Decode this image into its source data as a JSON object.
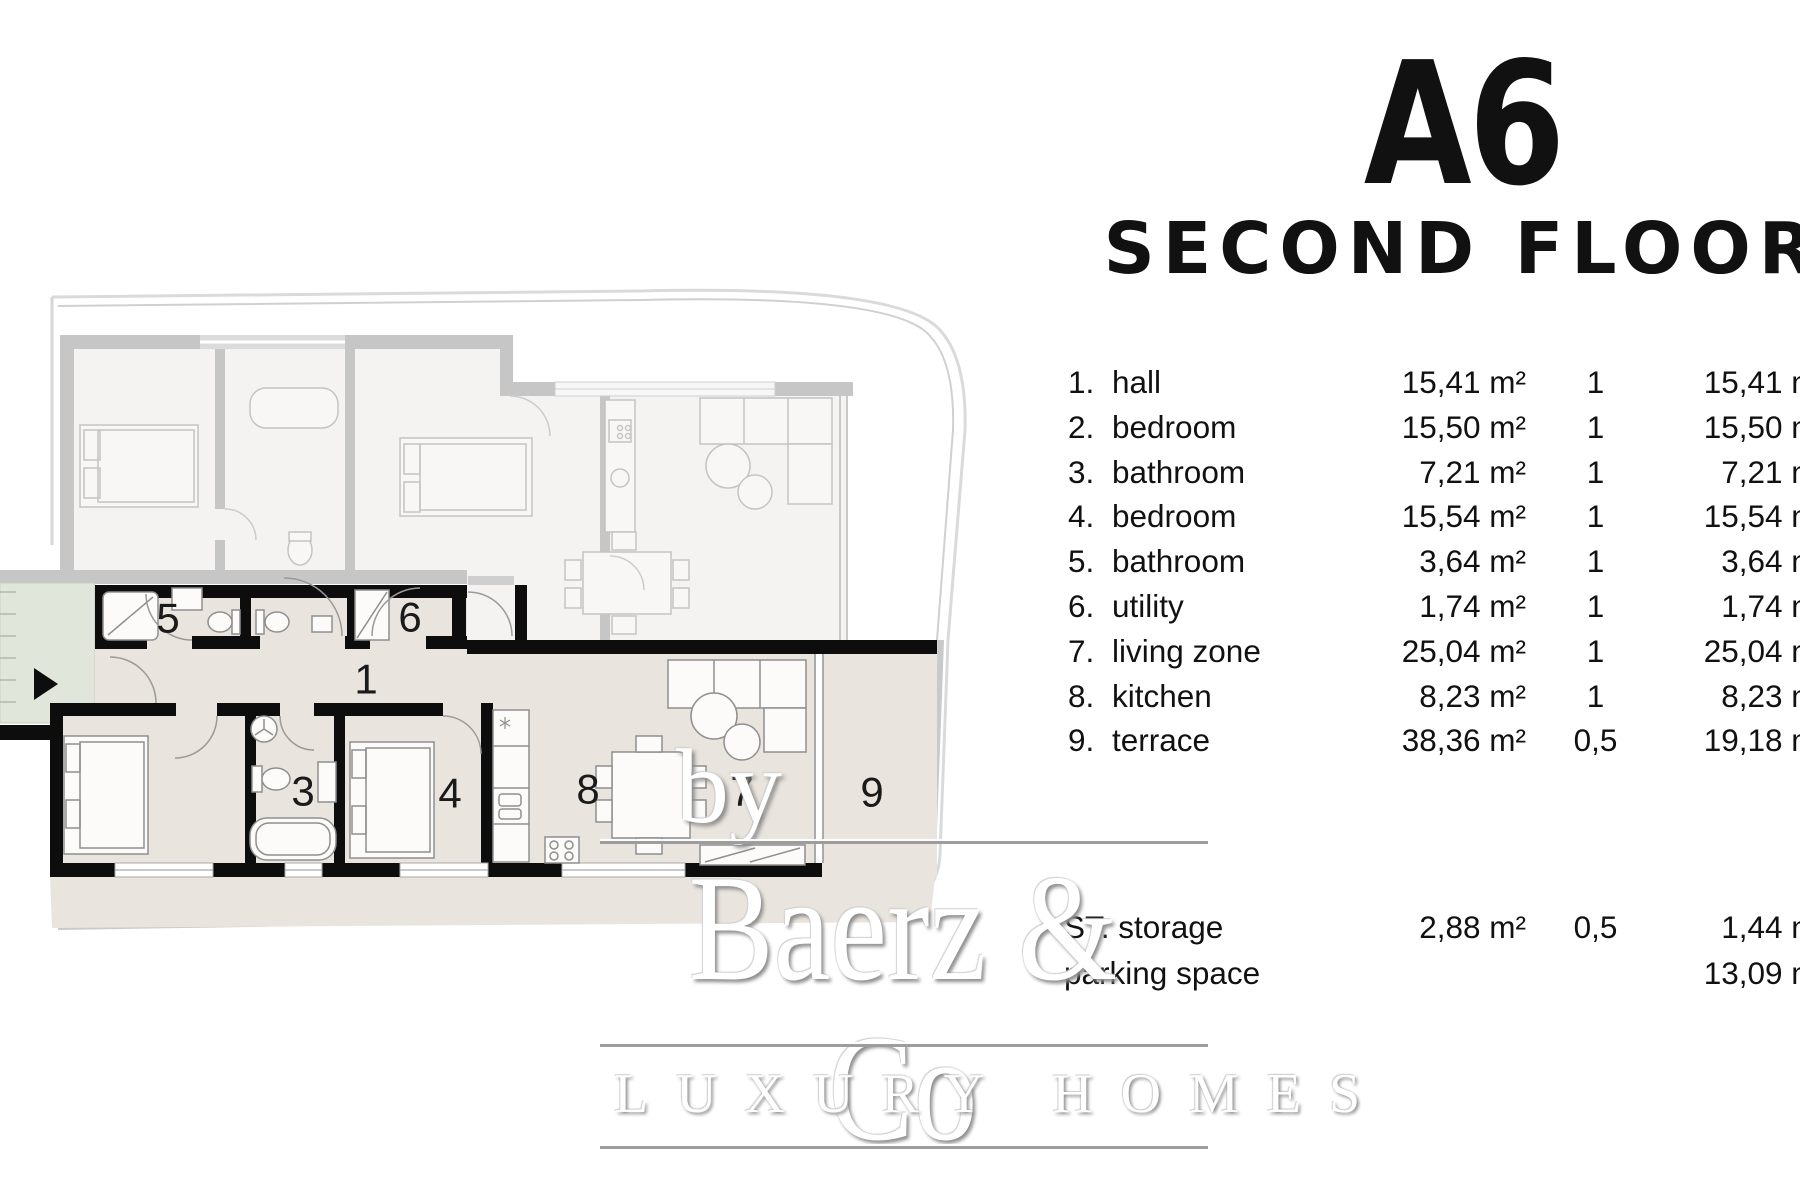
{
  "header": {
    "unit": "A6",
    "floor": "SECOND FLOOR"
  },
  "table": {
    "rooms": [
      {
        "num": "1.",
        "name": "hall",
        "area": "15,41 m²",
        "factor": "1",
        "total": "15,41 m²"
      },
      {
        "num": "2.",
        "name": "bedroom",
        "area": "15,50 m²",
        "factor": "1",
        "total": "15,50 m²"
      },
      {
        "num": "3.",
        "name": "bathroom",
        "area": "7,21 m²",
        "factor": "1",
        "total": "7,21 m²"
      },
      {
        "num": "4.",
        "name": "bedroom",
        "area": "15,54 m²",
        "factor": "1",
        "total": "15,54 m²"
      },
      {
        "num": "5.",
        "name": "bathroom",
        "area": "3,64 m²",
        "factor": "1",
        "total": "3,64 m²"
      },
      {
        "num": "6.",
        "name": "utility",
        "area": "1,74 m²",
        "factor": "1",
        "total": "1,74 m²"
      },
      {
        "num": "7.",
        "name": "living zone",
        "area": "25,04 m²",
        "factor": "1",
        "total": "25,04 m²"
      },
      {
        "num": "8.",
        "name": "kitchen",
        "area": "8,23 m²",
        "factor": "1",
        "total": "8,23 m²"
      },
      {
        "num": "9.",
        "name": "terrace",
        "area": "38,36 m²",
        "factor": "0,5",
        "total": "19,18 m²"
      }
    ],
    "extras": [
      {
        "name": "ST. storage",
        "area": "2,88 m²",
        "factor": "0,5",
        "total": "1,44 m²"
      },
      {
        "name": "parking space",
        "area": "",
        "factor": "",
        "total": "13,09 m²"
      }
    ]
  },
  "watermark": {
    "brand": "Baerz & Co",
    "tagline": "LUXURY HOMES",
    "by": "by"
  },
  "plan": {
    "labels": [
      {
        "text": "1",
        "x": 366,
        "y": 679
      },
      {
        "text": "3",
        "x": 303,
        "y": 791
      },
      {
        "text": "4",
        "x": 450,
        "y": 793
      },
      {
        "text": "5",
        "x": 168,
        "y": 618
      },
      {
        "text": "6",
        "x": 410,
        "y": 617
      },
      {
        "text": "7",
        "x": 742,
        "y": 791
      },
      {
        "text": "8",
        "x": 588,
        "y": 789
      },
      {
        "text": "9",
        "x": 872,
        "y": 792
      }
    ],
    "colors": {
      "active_floor": "#e9e4dd",
      "wall": "#0d0d0d",
      "faded_wall": "#c6c6c6",
      "faded_floor": "#f4f3f1",
      "entry_zone": "#e1e6da",
      "boundary": "#d6d6d6"
    }
  }
}
